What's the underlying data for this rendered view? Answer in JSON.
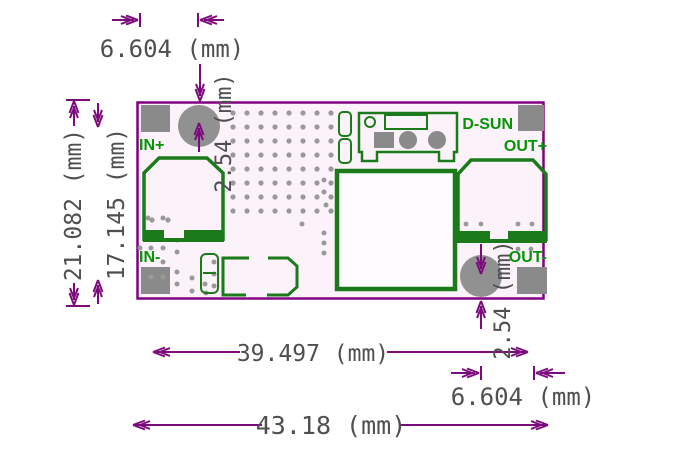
{
  "drawing": {
    "type": "pcb-dimension-drawing",
    "units": "mm"
  },
  "board_labels": {
    "in_plus": "IN+",
    "in_minus": "IN-",
    "out_plus": "OUT+",
    "out_minus": "OUT-",
    "brand": "D-SUN"
  },
  "dimensions": {
    "top_hole_offset_x": "6.604 (mm)",
    "top_hole_offset_y": "2.54 (mm)",
    "board_height": "21.082 (mm)",
    "pad_row_pitch": "17.145 (mm)",
    "pad_column_pitch": "39.497 (mm)",
    "board_width": "43.18 (mm)",
    "bottom_hole_offset_x": "6.604 (mm)",
    "bottom_hole_offset_y": "2.54 (mm)"
  },
  "colors": {
    "dimension_purple": "#7c0a7c",
    "board_outline_purple": "#800080",
    "silkscreen_green": "#1b7b1b",
    "label_green": "#059405",
    "pad_gray": "#8a8a8a",
    "hole_gray": "#919191",
    "via_gray": "#999999",
    "dimension_text_gray": "#4f4f4f",
    "board_fill": "#fcf2fa",
    "background": "#ffffff"
  }
}
